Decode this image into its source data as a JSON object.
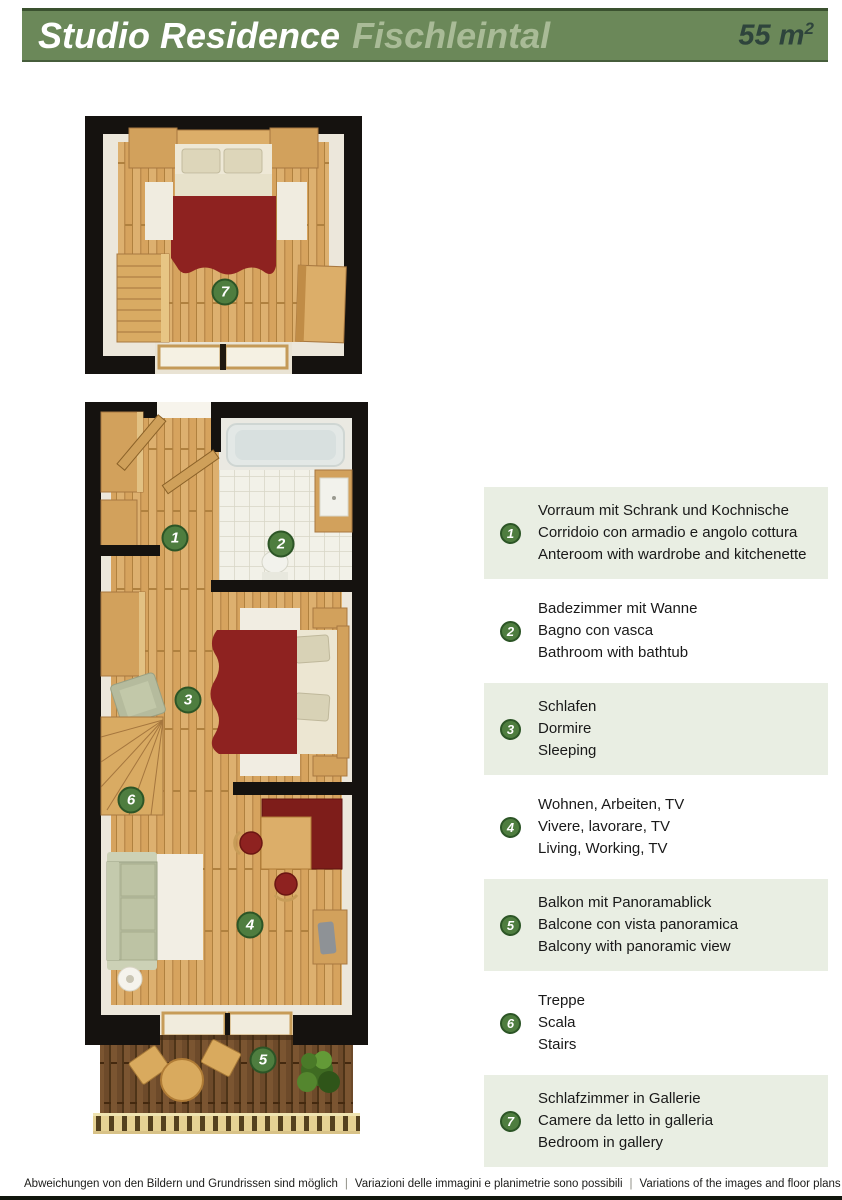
{
  "header": {
    "title": "Studio Residence",
    "subtitle": "Fischleintal",
    "area_value": "55 m",
    "area_exp": "2"
  },
  "legend": [
    {
      "number": "1",
      "de": "Vorraum mit Schrank und Kochnische",
      "it": "Corridoio con armadio e angolo cottura",
      "en": "Anteroom with wardrobe and kitchenette",
      "highlighted": true
    },
    {
      "number": "2",
      "de": "Badezimmer mit Wanne",
      "it": "Bagno con vasca",
      "en": "Bathroom with bathtub",
      "highlighted": false
    },
    {
      "number": "3",
      "de": "Schlafen",
      "it": "Dormire",
      "en": "Sleeping",
      "highlighted": true
    },
    {
      "number": "4",
      "de": "Wohnen, Arbeiten, TV",
      "it": "Vivere, lavorare, TV",
      "en": "Living, Working, TV",
      "highlighted": false
    },
    {
      "number": "5",
      "de": "Balkon mit Panoramablick",
      "it": "Balcone con vista panoramica",
      "en": "Balcony with panoramic view",
      "highlighted": true
    },
    {
      "number": "6",
      "de": "Treppe",
      "it": "Scala",
      "en": "Stairs",
      "highlighted": false
    },
    {
      "number": "7",
      "de": "Schlafzimmer in Gallerie",
      "it": "Camere da letto in galleria",
      "en": "Bedroom in gallery",
      "highlighted": true
    }
  ],
  "plan_badges": {
    "room1": "1",
    "room2": "2",
    "room3": "3",
    "room4": "4",
    "room5": "5",
    "room6": "6",
    "gallery": "7"
  },
  "footer": {
    "de": "Abweichungen von den Bildern und Grundrissen sind möglich",
    "it": "Variazioni delle immagini e planimetrie sono possibili",
    "en": "Variations of the images and floor plans are possible",
    "separator": "|"
  },
  "colors": {
    "header_green": "#6b8859",
    "header_rule": "#3a512f",
    "subtitle_green": "#a9bb97",
    "area_text": "#2e443c",
    "legend_bg": "#e9eee3",
    "badge_green": "#4e7d3f",
    "badge_ring": "#2c5526",
    "wall_black": "#15120f",
    "wood": "#d6a35e",
    "blanket_red": "#8e2220",
    "sofa_sage": "#b7bd9f",
    "deck_brown": "#6d4a2a",
    "railing_wood": "#e5d193",
    "tile_white": "#f2f1e8"
  }
}
